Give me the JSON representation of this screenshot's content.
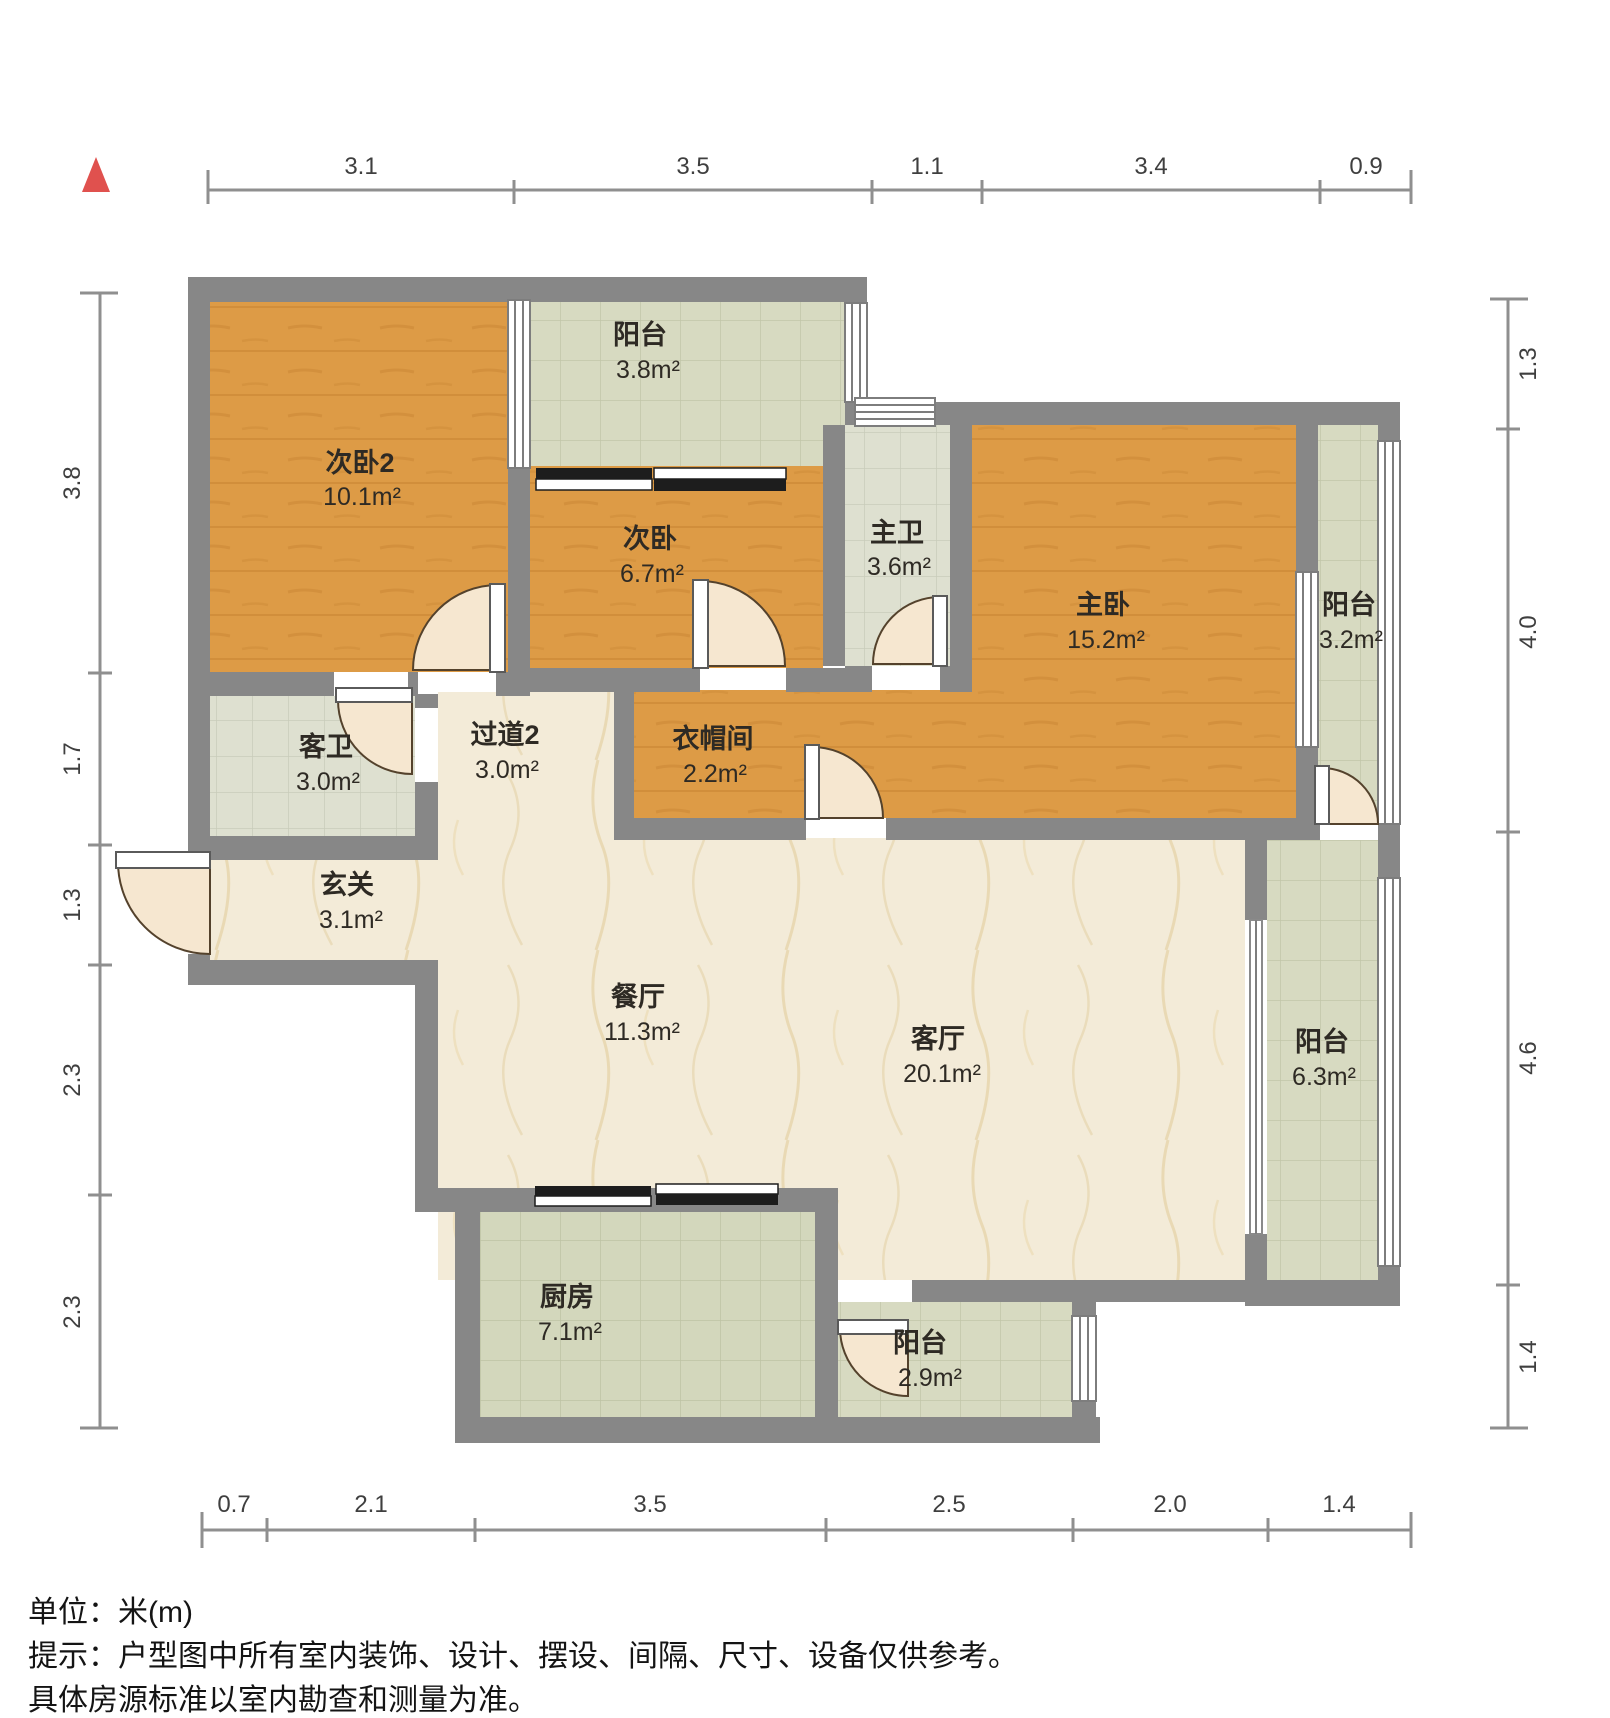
{
  "title": "户型图",
  "north_indicator": "north-arrow",
  "rooms": [
    {
      "name": "次卧2",
      "area": "10.1m²"
    },
    {
      "name": "阳台",
      "area": "3.8m²"
    },
    {
      "name": "次卧",
      "area": "6.7m²"
    },
    {
      "name": "主卫",
      "area": "3.6m²"
    },
    {
      "name": "主卧",
      "area": "15.2m²"
    },
    {
      "name": "阳台",
      "area": "3.2m²"
    },
    {
      "name": "客卫",
      "area": "3.0m²"
    },
    {
      "name": "过道2",
      "area": "3.0m²"
    },
    {
      "name": "衣帽间",
      "area": "2.2m²"
    },
    {
      "name": "玄关",
      "area": "3.1m²"
    },
    {
      "name": "餐厅",
      "area": "11.3m²"
    },
    {
      "name": "客厅",
      "area": "20.1m²"
    },
    {
      "name": "阳台",
      "area": "6.3m²"
    },
    {
      "name": "厨房",
      "area": "7.1m²"
    },
    {
      "name": "阳台",
      "area": "2.9m²"
    }
  ],
  "dims": {
    "top": [
      "3.1",
      "3.5",
      "1.1",
      "3.4",
      "0.9"
    ],
    "left": [
      "3.8",
      "1.7",
      "1.3",
      "2.3",
      "2.3"
    ],
    "right": [
      "1.3",
      "4.0",
      "4.6",
      "1.4"
    ],
    "bottom": [
      "0.7",
      "2.1",
      "3.5",
      "2.5",
      "2.0",
      "1.4"
    ]
  },
  "notes": {
    "unit": "单位：米(m)",
    "hint1": "提示：户型图中所有室内装饰、设计、摆设、间隔、尺寸、设备仅供参考。",
    "hint2": "具体房源标准以室内勘查和测量为准。"
  },
  "colors": {
    "wall": "#878787",
    "wood": "#dd9b46",
    "marble": "#f3ebd8",
    "tile_balcony": "#d7dac1",
    "tile_bath": "#dee0d0",
    "tile_kitchen": "#d3d7bc",
    "north_red": "#e0514e"
  }
}
